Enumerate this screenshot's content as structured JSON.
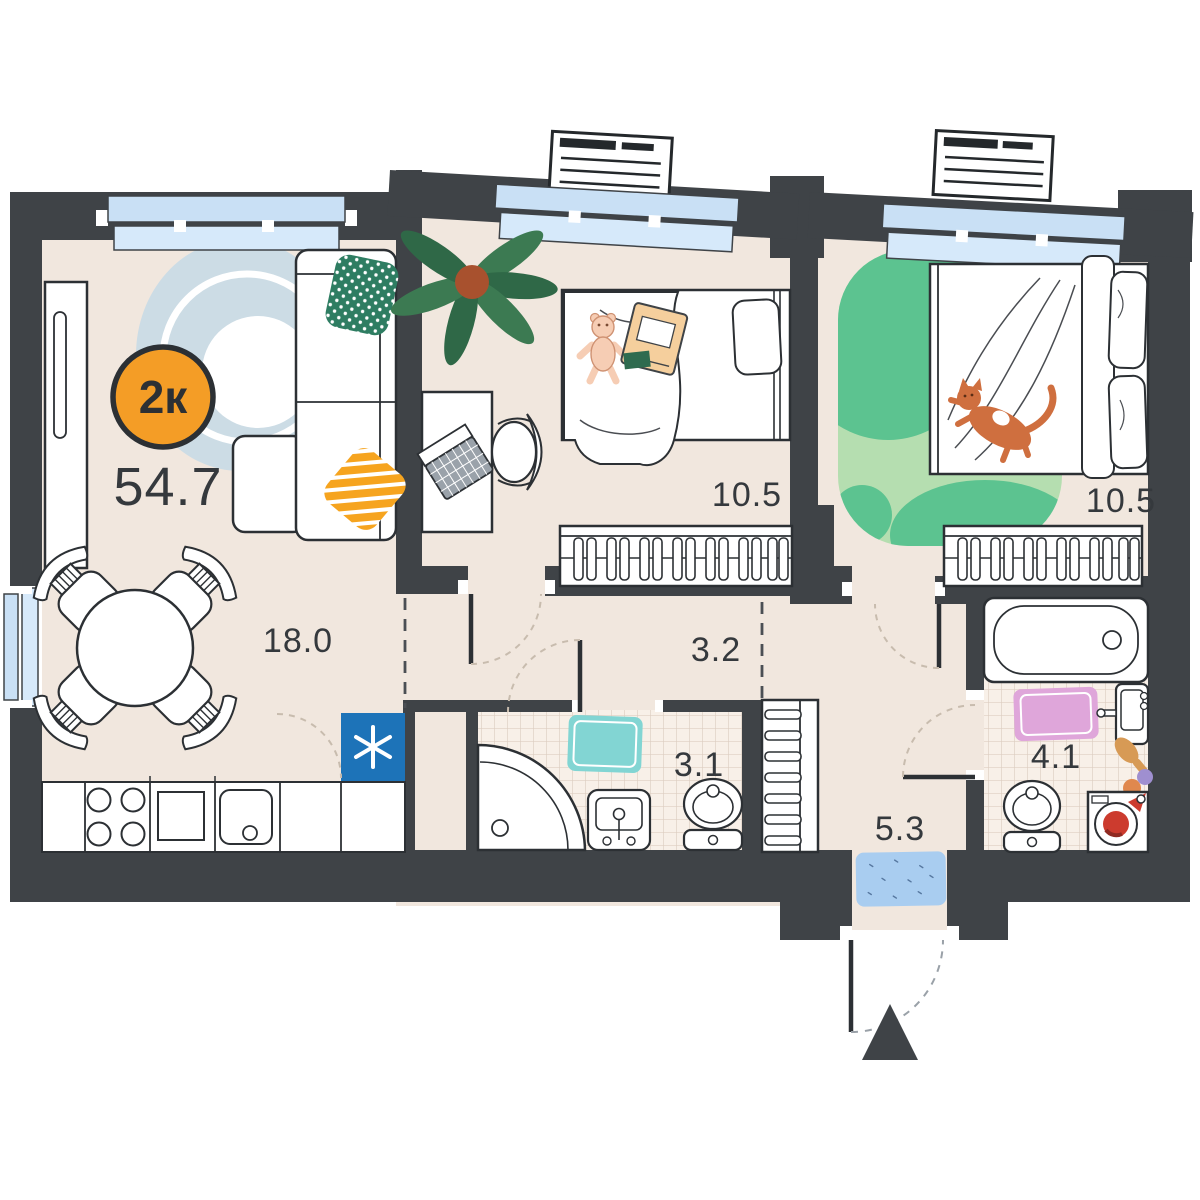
{
  "floorplan": {
    "badge": {
      "type": "2к",
      "total_area": "54.7"
    },
    "rooms": {
      "living_kitchen": {
        "area": "18.0"
      },
      "children_room": {
        "area": "10.5"
      },
      "bedroom": {
        "area": "10.5"
      },
      "corridor": {
        "area": "3.2"
      },
      "bathroom_small": {
        "area": "3.1"
      },
      "hallway": {
        "area": "5.3"
      },
      "bathroom_large": {
        "area": "4.1"
      }
    },
    "colors": {
      "wall": "#3f4347",
      "outline": "#2c3034",
      "floor": "#f1e7de",
      "tile_floor": "#f8f0e8",
      "window_blue": "#c9e0f5",
      "badge_orange": "#f49d26",
      "fridge_blue": "#1d73b8",
      "label_text": "#35393d",
      "rug_blue_gray": "#ccdce5",
      "rug_green_light": "#b5deb0",
      "rug_green_dark": "#5cc390",
      "mat_teal": "#82d5d3",
      "mat_pink": "#dfa6da",
      "doormat_blue": "#a9cdf0",
      "cat_orange": "#cf6f3f",
      "pillow_green": "#2e7d62",
      "pillow_orange": "#f6a41f"
    },
    "icons": {
      "fridge": "snowflake-icon",
      "entrance": "entrance-arrow-icon"
    }
  }
}
